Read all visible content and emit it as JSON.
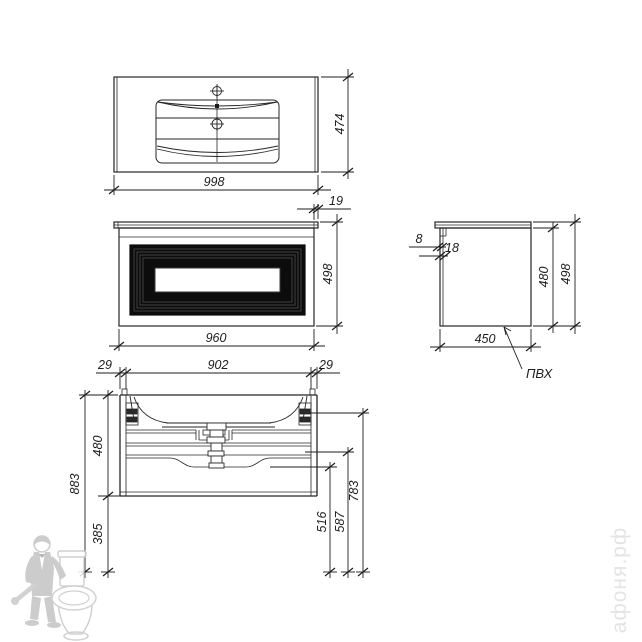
{
  "views": {
    "top": {
      "dim_width": "998",
      "dim_depth": "474",
      "dim_overhang": "19"
    },
    "front": {
      "dim_width": "960",
      "dim_height": "498"
    },
    "side": {
      "dim_panel": "8",
      "dim_top": "18",
      "dim_inner_height": "480",
      "dim_total_height": "498",
      "dim_depth": "450",
      "material_label": "ПВХ"
    },
    "section": {
      "dim_side_left": "29",
      "dim_inner_width": "902",
      "dim_side_right": "29",
      "dim_inner_height": "480",
      "dim_total_height": "883",
      "dim_floor_gap": "385",
      "dim_level_1": "516",
      "dim_level_2": "587",
      "dim_level_3": "783"
    }
  },
  "watermarks": {
    "site": "афоня.рф"
  },
  "colors": {
    "line": "#262626",
    "panel_fill": "#0c0c0c",
    "watermark_gray": "#c7c7c7",
    "watermark_text": "#e4e4e4"
  }
}
